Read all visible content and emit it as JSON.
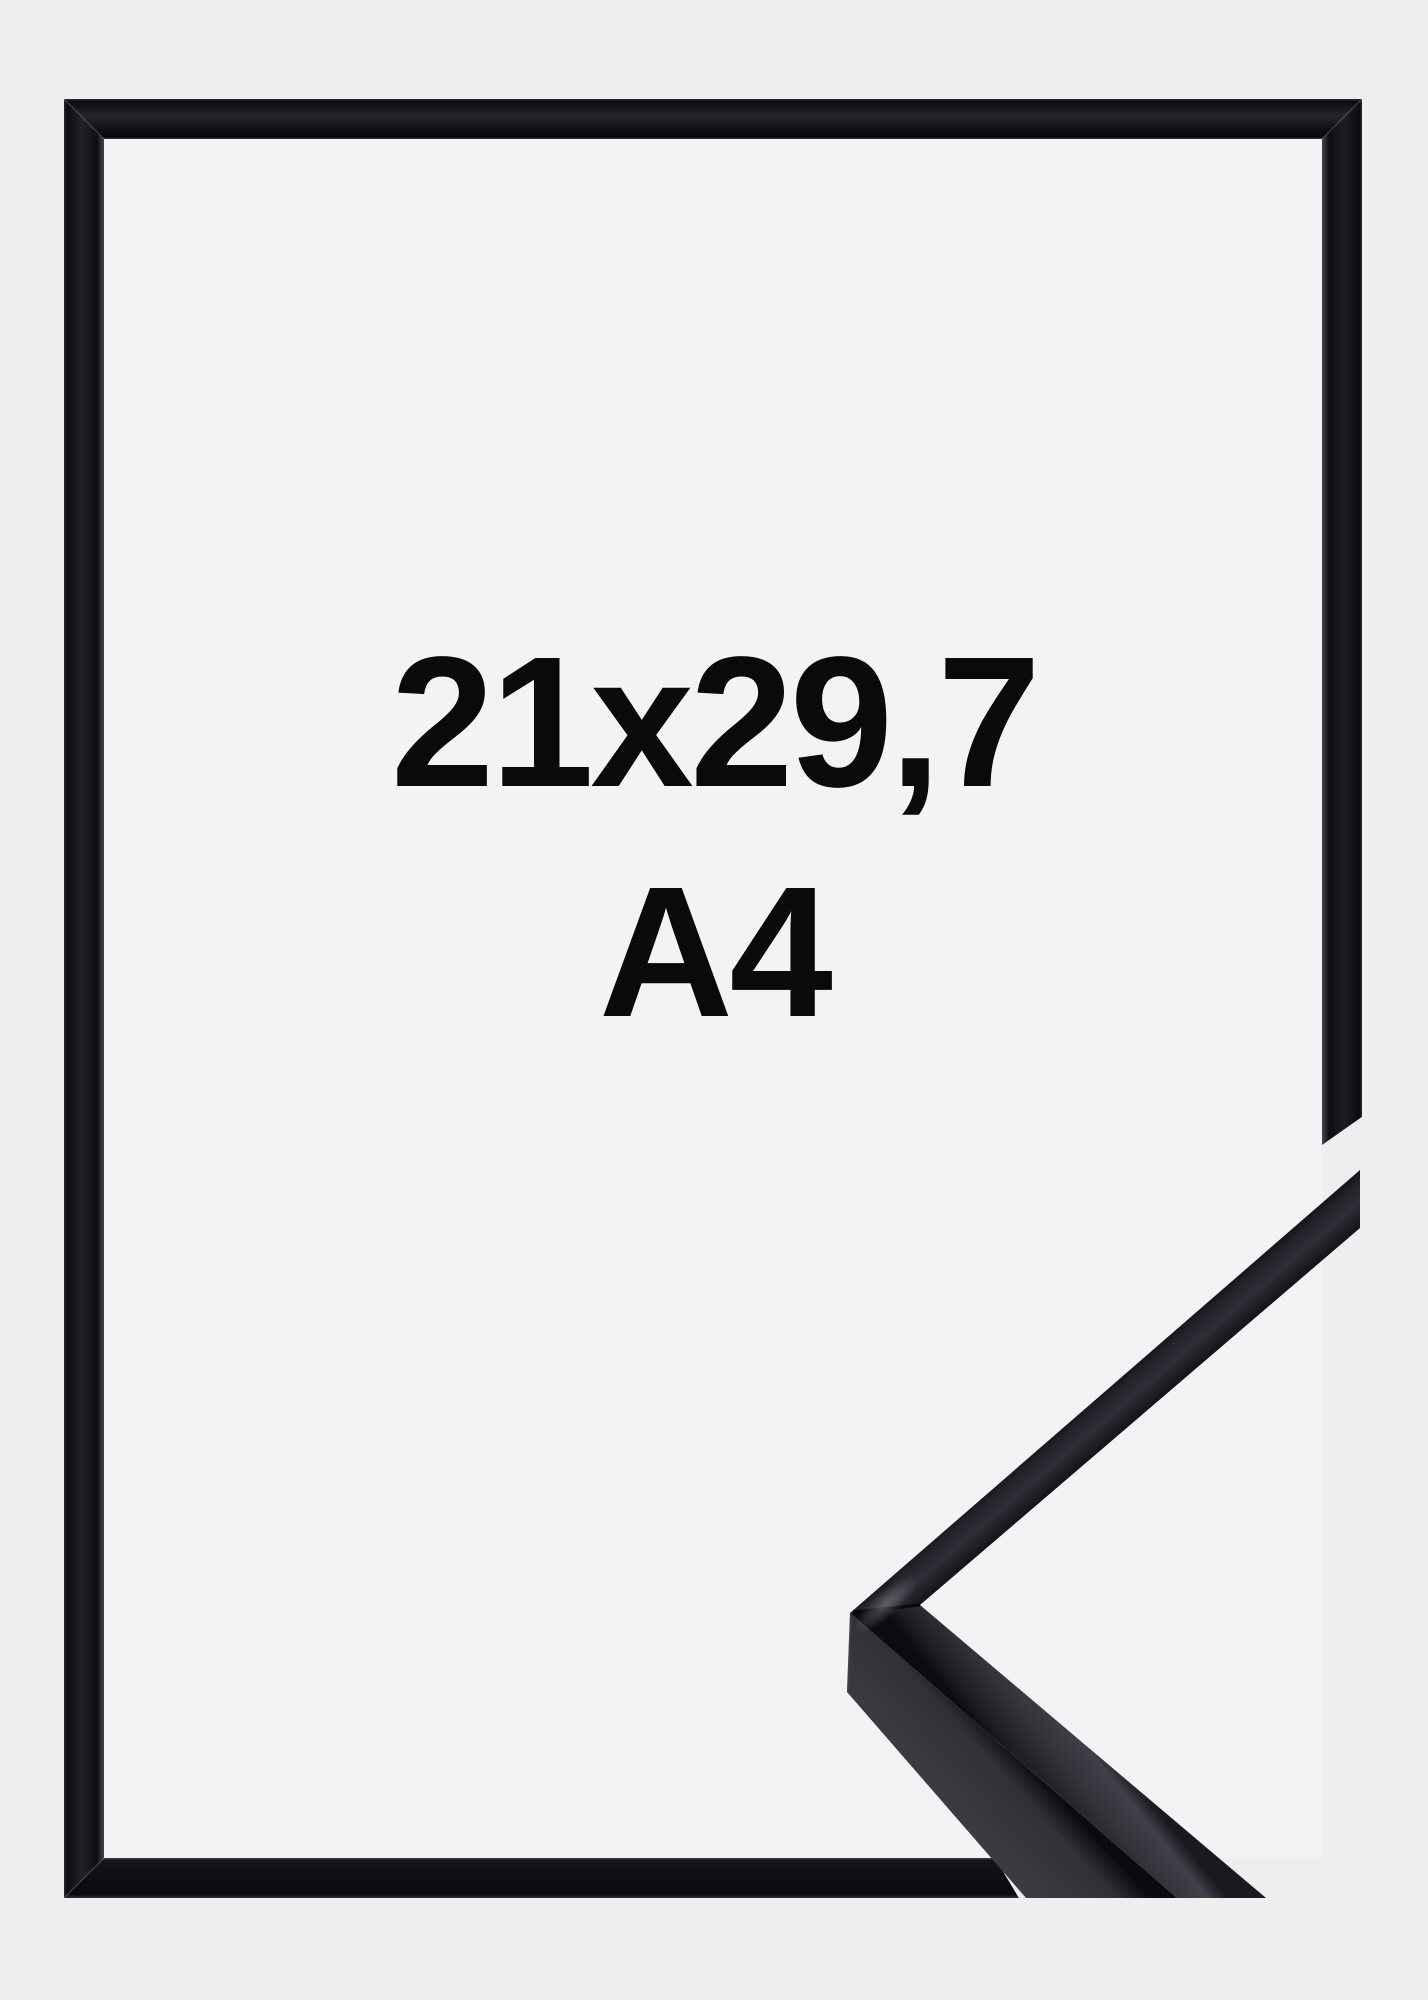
{
  "image": {
    "dimensions_label": "21x29,7",
    "format_label": "A4",
    "colors": {
      "background": "#edeef0",
      "inner_area": "#f3f3f5",
      "frame_black": "#121218",
      "closeup_top_face": "#34343b",
      "closeup_side_face": "#3a3a41",
      "text": "#0a0a0a"
    }
  }
}
